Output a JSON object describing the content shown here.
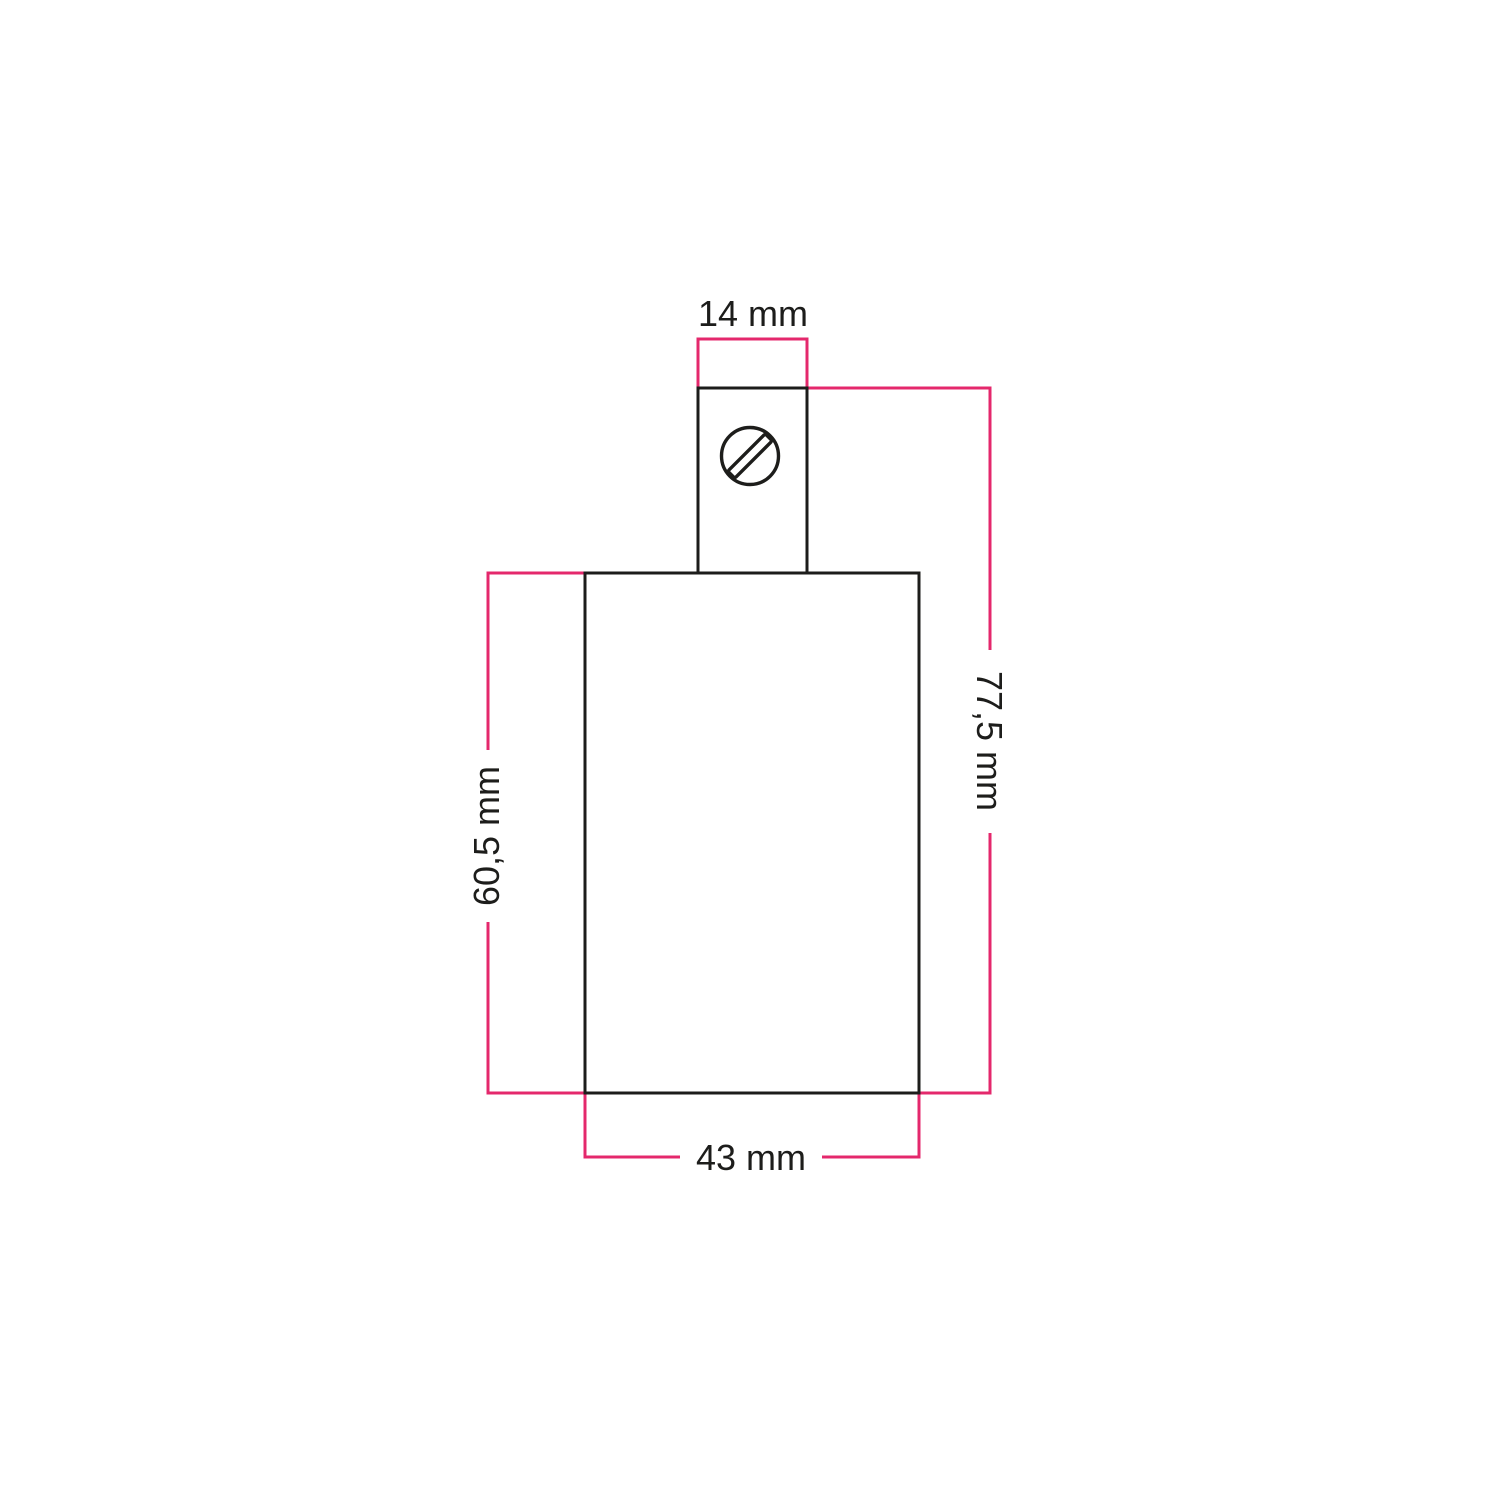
{
  "colors": {
    "background": "#ffffff",
    "outline": "#1d1d1b",
    "dimension_line": "#e4286c",
    "text": "#1d1d1b"
  },
  "labels": {
    "top": "14 mm",
    "right": "77,5 mm",
    "left": "60,5 mm",
    "bottom": "43 mm"
  },
  "icons": {
    "screw": "slotted-screw-head-icon"
  }
}
